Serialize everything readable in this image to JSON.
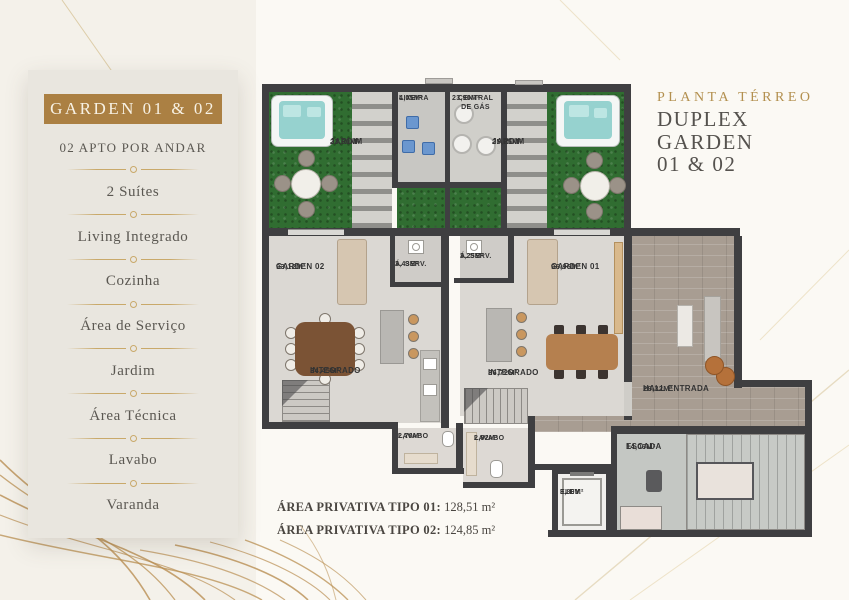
{
  "sidebar": {
    "header": "GARDEN 01 & 02",
    "items": [
      "02 APTO POR ANDAR",
      "2 Suítes",
      "Living Integrado",
      "Cozinha",
      "Área de Serviço",
      "Jardim",
      "Área Técnica",
      "Lavabo",
      "Varanda"
    ]
  },
  "title": {
    "kicker": "PLANTA TÉRREO",
    "line1": "DUPLEX GARDEN",
    "line2": "01 & 02"
  },
  "plan": {
    "rooms": {
      "jardim_esq": {
        "name": "JARDIM",
        "area": "23,90M²"
      },
      "lixeira": {
        "name": "LIXEIRA",
        "area": "4,05M²"
      },
      "central_gas": {
        "name": "CENTRAL DE GÁS",
        "area": "23,90M²"
      },
      "jardim_dir": {
        "name": "JARDIM",
        "area": "25,25M²"
      },
      "garden02": {
        "name": "GARDEN 02",
        "area": "93,12M²"
      },
      "aserv02": {
        "name": "Á. SERV.",
        "area": "3,43M²"
      },
      "aserv01": {
        "name": "Á. SERV.",
        "area": "3,25M²"
      },
      "garden01": {
        "name": "GARDEN 01",
        "area": "96,96M²"
      },
      "integrado02": {
        "name": "INTEGRADO",
        "area": "34,45M²"
      },
      "integrado01": {
        "name": "INTEGRADO",
        "area": "36,72M²"
      },
      "lavabo02": {
        "name": "LAVABO",
        "area": "2,70M²"
      },
      "lavabo01": {
        "name": "LAVABO",
        "area": "2,92M²"
      },
      "hall": {
        "name": "HALL ENTRADA",
        "area": "28,32M²"
      },
      "escada": {
        "name": "ESCADA",
        "area": "14,06M²"
      },
      "elev": {
        "name": "ELEV.",
        "area": "3,80M²"
      }
    }
  },
  "footer": {
    "line1_label": "ÁREA PRIVATIVA TIPO 01:",
    "line1_value": "128,51 m²",
    "line2_label": "ÁREA PRIVATIVA TIPO 02:",
    "line2_value": "124,85 m²"
  },
  "colors": {
    "gold": "#ab8043",
    "gold_light": "#c9a96a",
    "title_gold": "#b3904f",
    "text_dark": "#4a4641",
    "wall": "#3f3f41",
    "grass": "#306d31",
    "wood": "#a89d92"
  }
}
